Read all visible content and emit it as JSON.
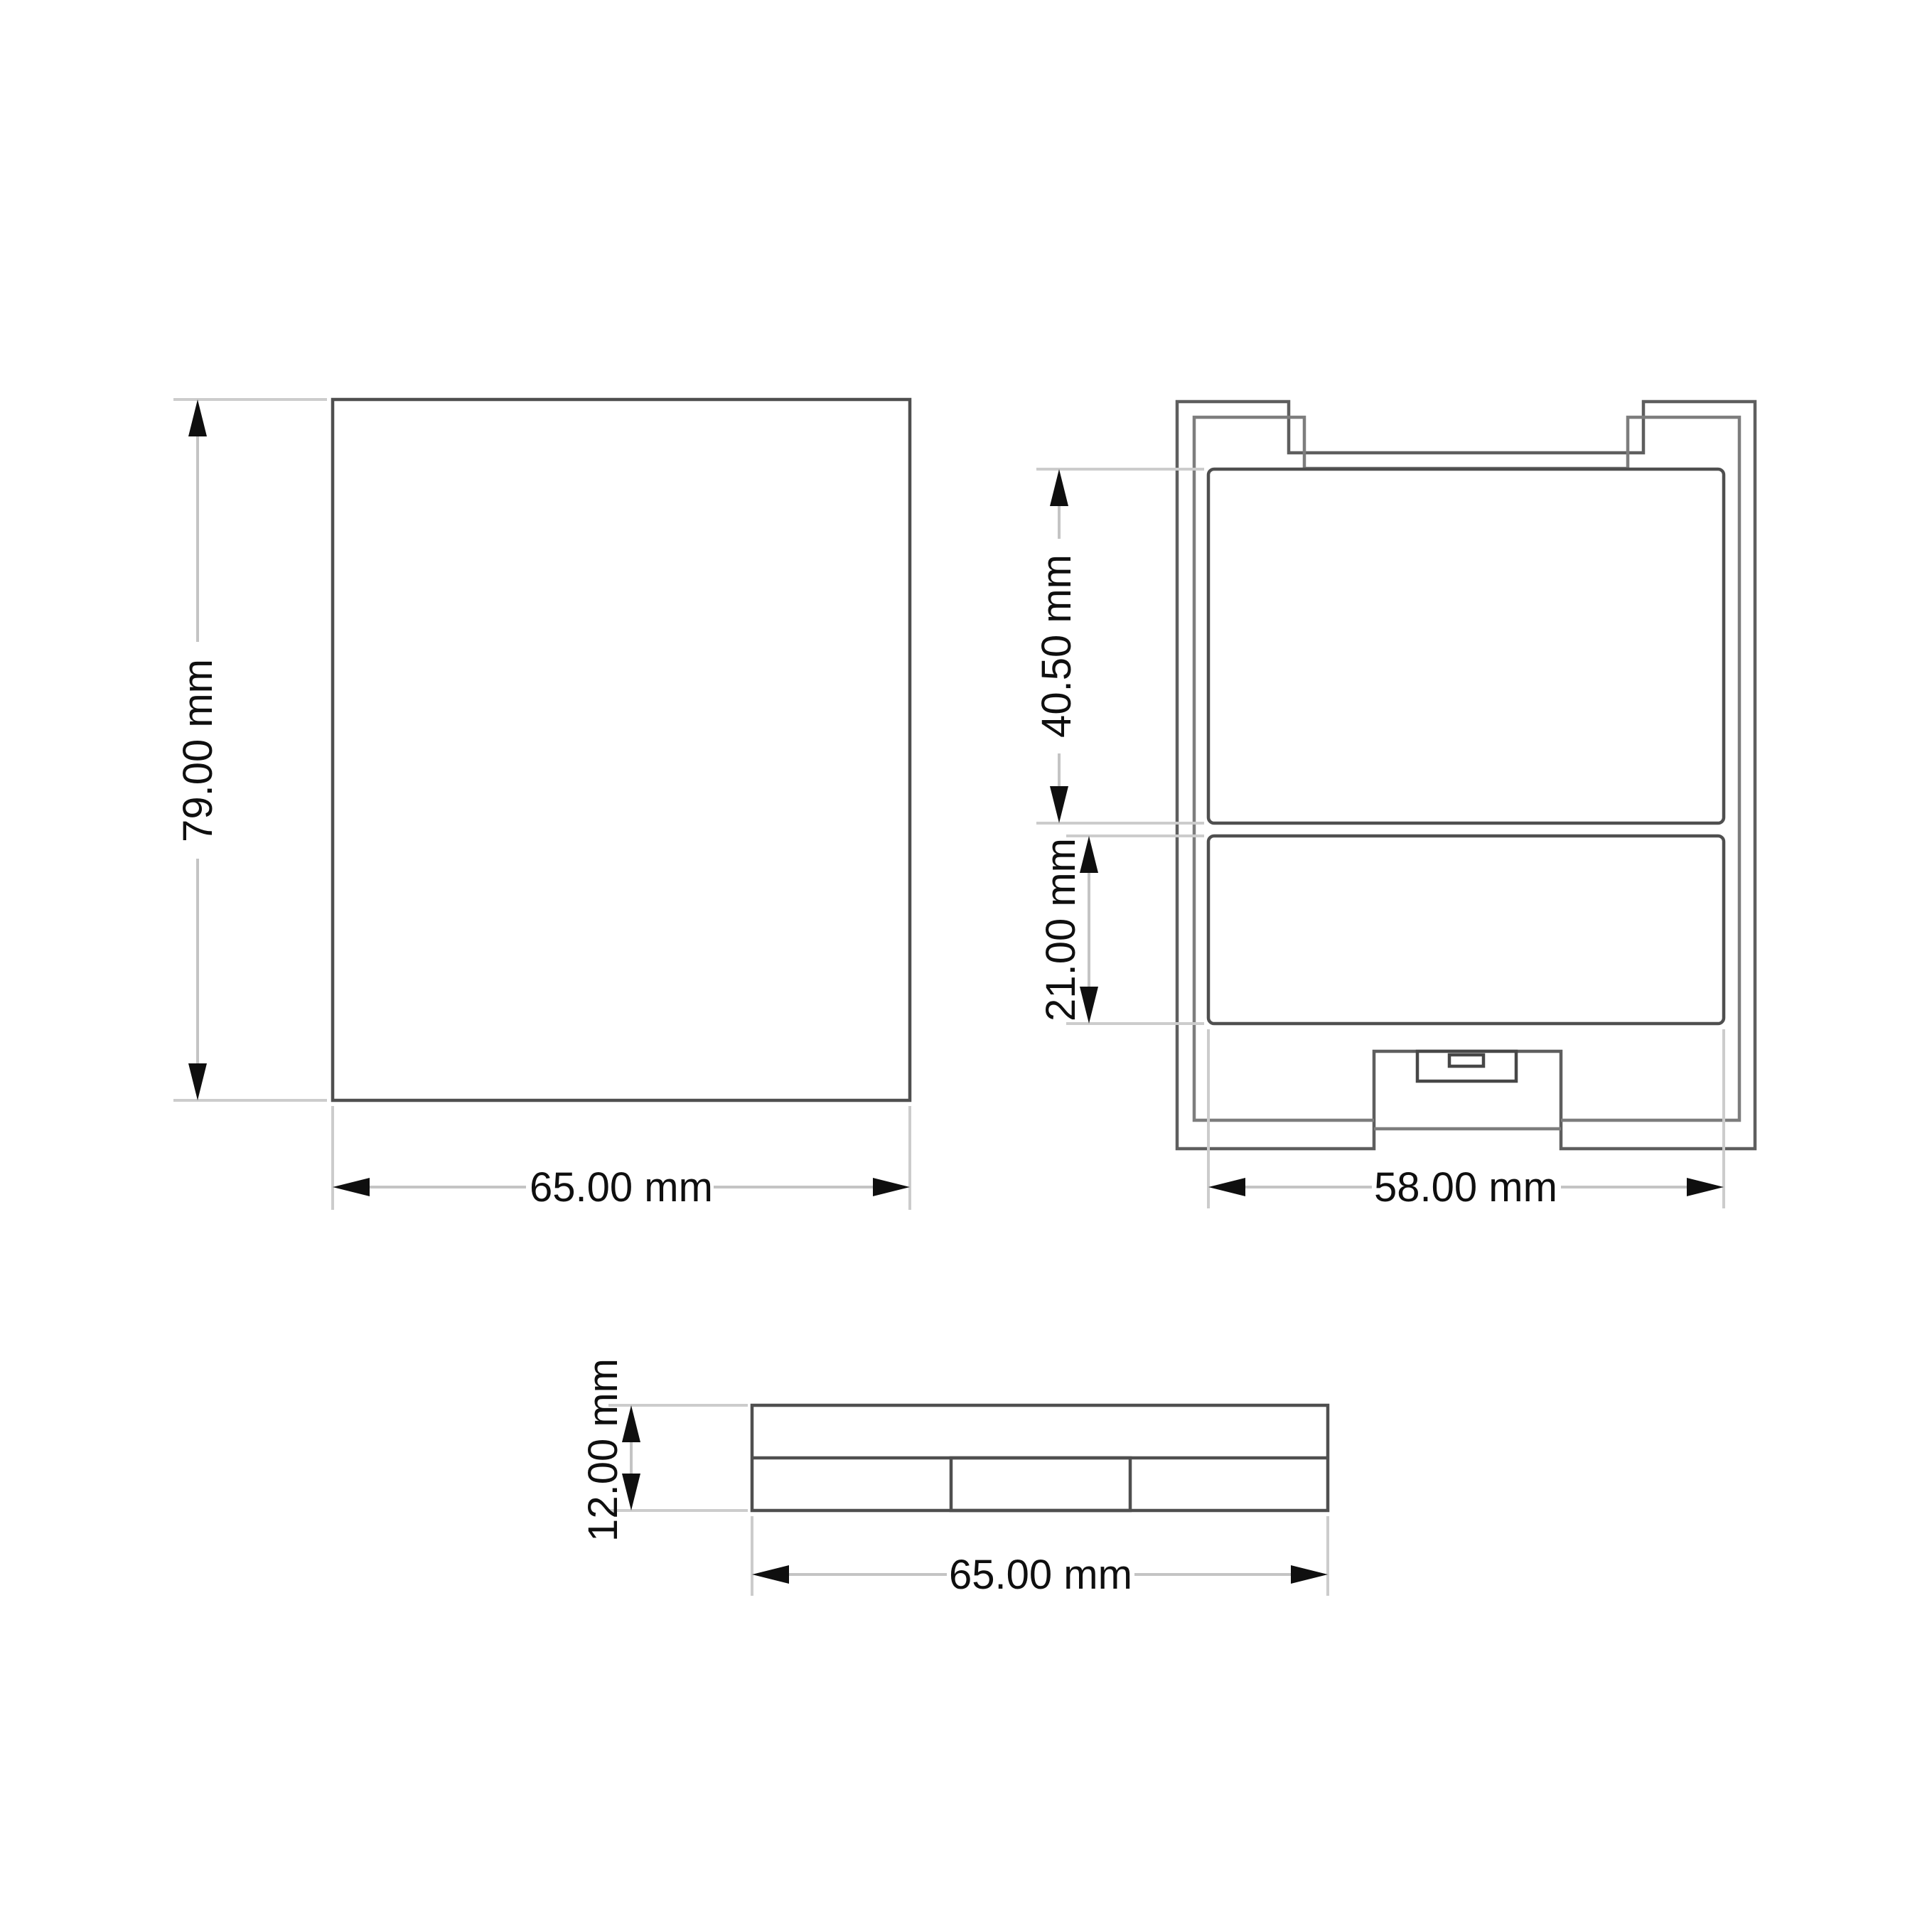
{
  "background": "#ffffff",
  "units": "mm",
  "colors": {
    "outline": "#5e5e5e",
    "panel_outline": "#4f4f4f",
    "extension_line": "#cccccc",
    "dimension_line": "#c4c4c4",
    "arrow": "#0f0f0f",
    "text": "#0f0f0f"
  },
  "views": {
    "front": {
      "height_label": "79.00 mm",
      "width_label": "65.00 mm",
      "height_mm": 79.0,
      "width_mm": 65.0
    },
    "rear": {
      "upper_label": "40.50 mm",
      "lower_label": "21.00 mm",
      "width_label": "58.00 mm",
      "upper_mm": 40.5,
      "lower_mm": 21.0,
      "width_mm": 58.0
    },
    "side": {
      "height_label": "12.00 mm",
      "width_label": "65.00 mm",
      "height_mm": 12.0,
      "width_mm": 65.0
    }
  }
}
